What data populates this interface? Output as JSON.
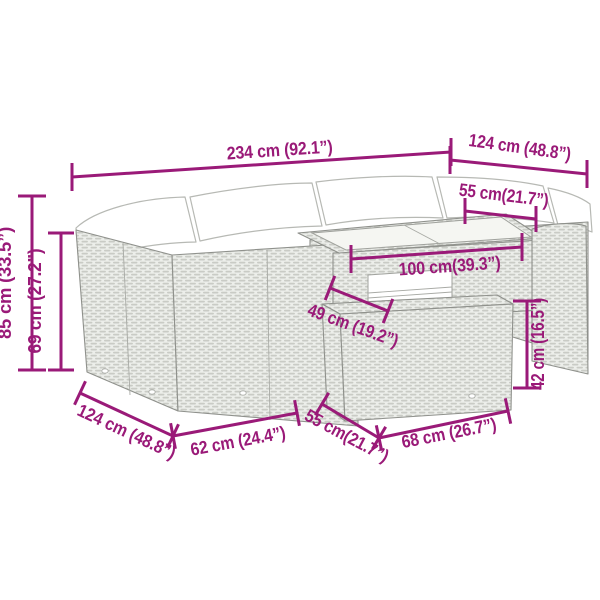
{
  "diagram": {
    "type": "product-dimension-diagram",
    "subject": "poly-rattan garden lounge set with corner sofa, glass-top table and footstool",
    "background_color": "#ffffff",
    "accent_color": "#9a1a78",
    "artwork_line_color": "#9fa19c",
    "rattan_fill_color": "#eceeea",
    "cushion_color": "#ffffff"
  },
  "labels": {
    "total_width": "234 cm (92.1”)",
    "side_depth_right": "124 cm (48.8”)",
    "seat_depth": "55 cm(21.7”)",
    "total_height": "85 cm (33.5”)",
    "backrest_height": "69 cm (27.2”)",
    "table_length": "100 cm(39.3”)",
    "table_depth": "49 cm (19.2”)",
    "side_depth_left": "124 cm (48.8”)",
    "seat_width": "62 cm (24.4”)",
    "stool_depth": "55 cm(21.7”)",
    "stool_width": "68 cm (26.7”)",
    "stool_height": "42 cm (16.5”)"
  }
}
